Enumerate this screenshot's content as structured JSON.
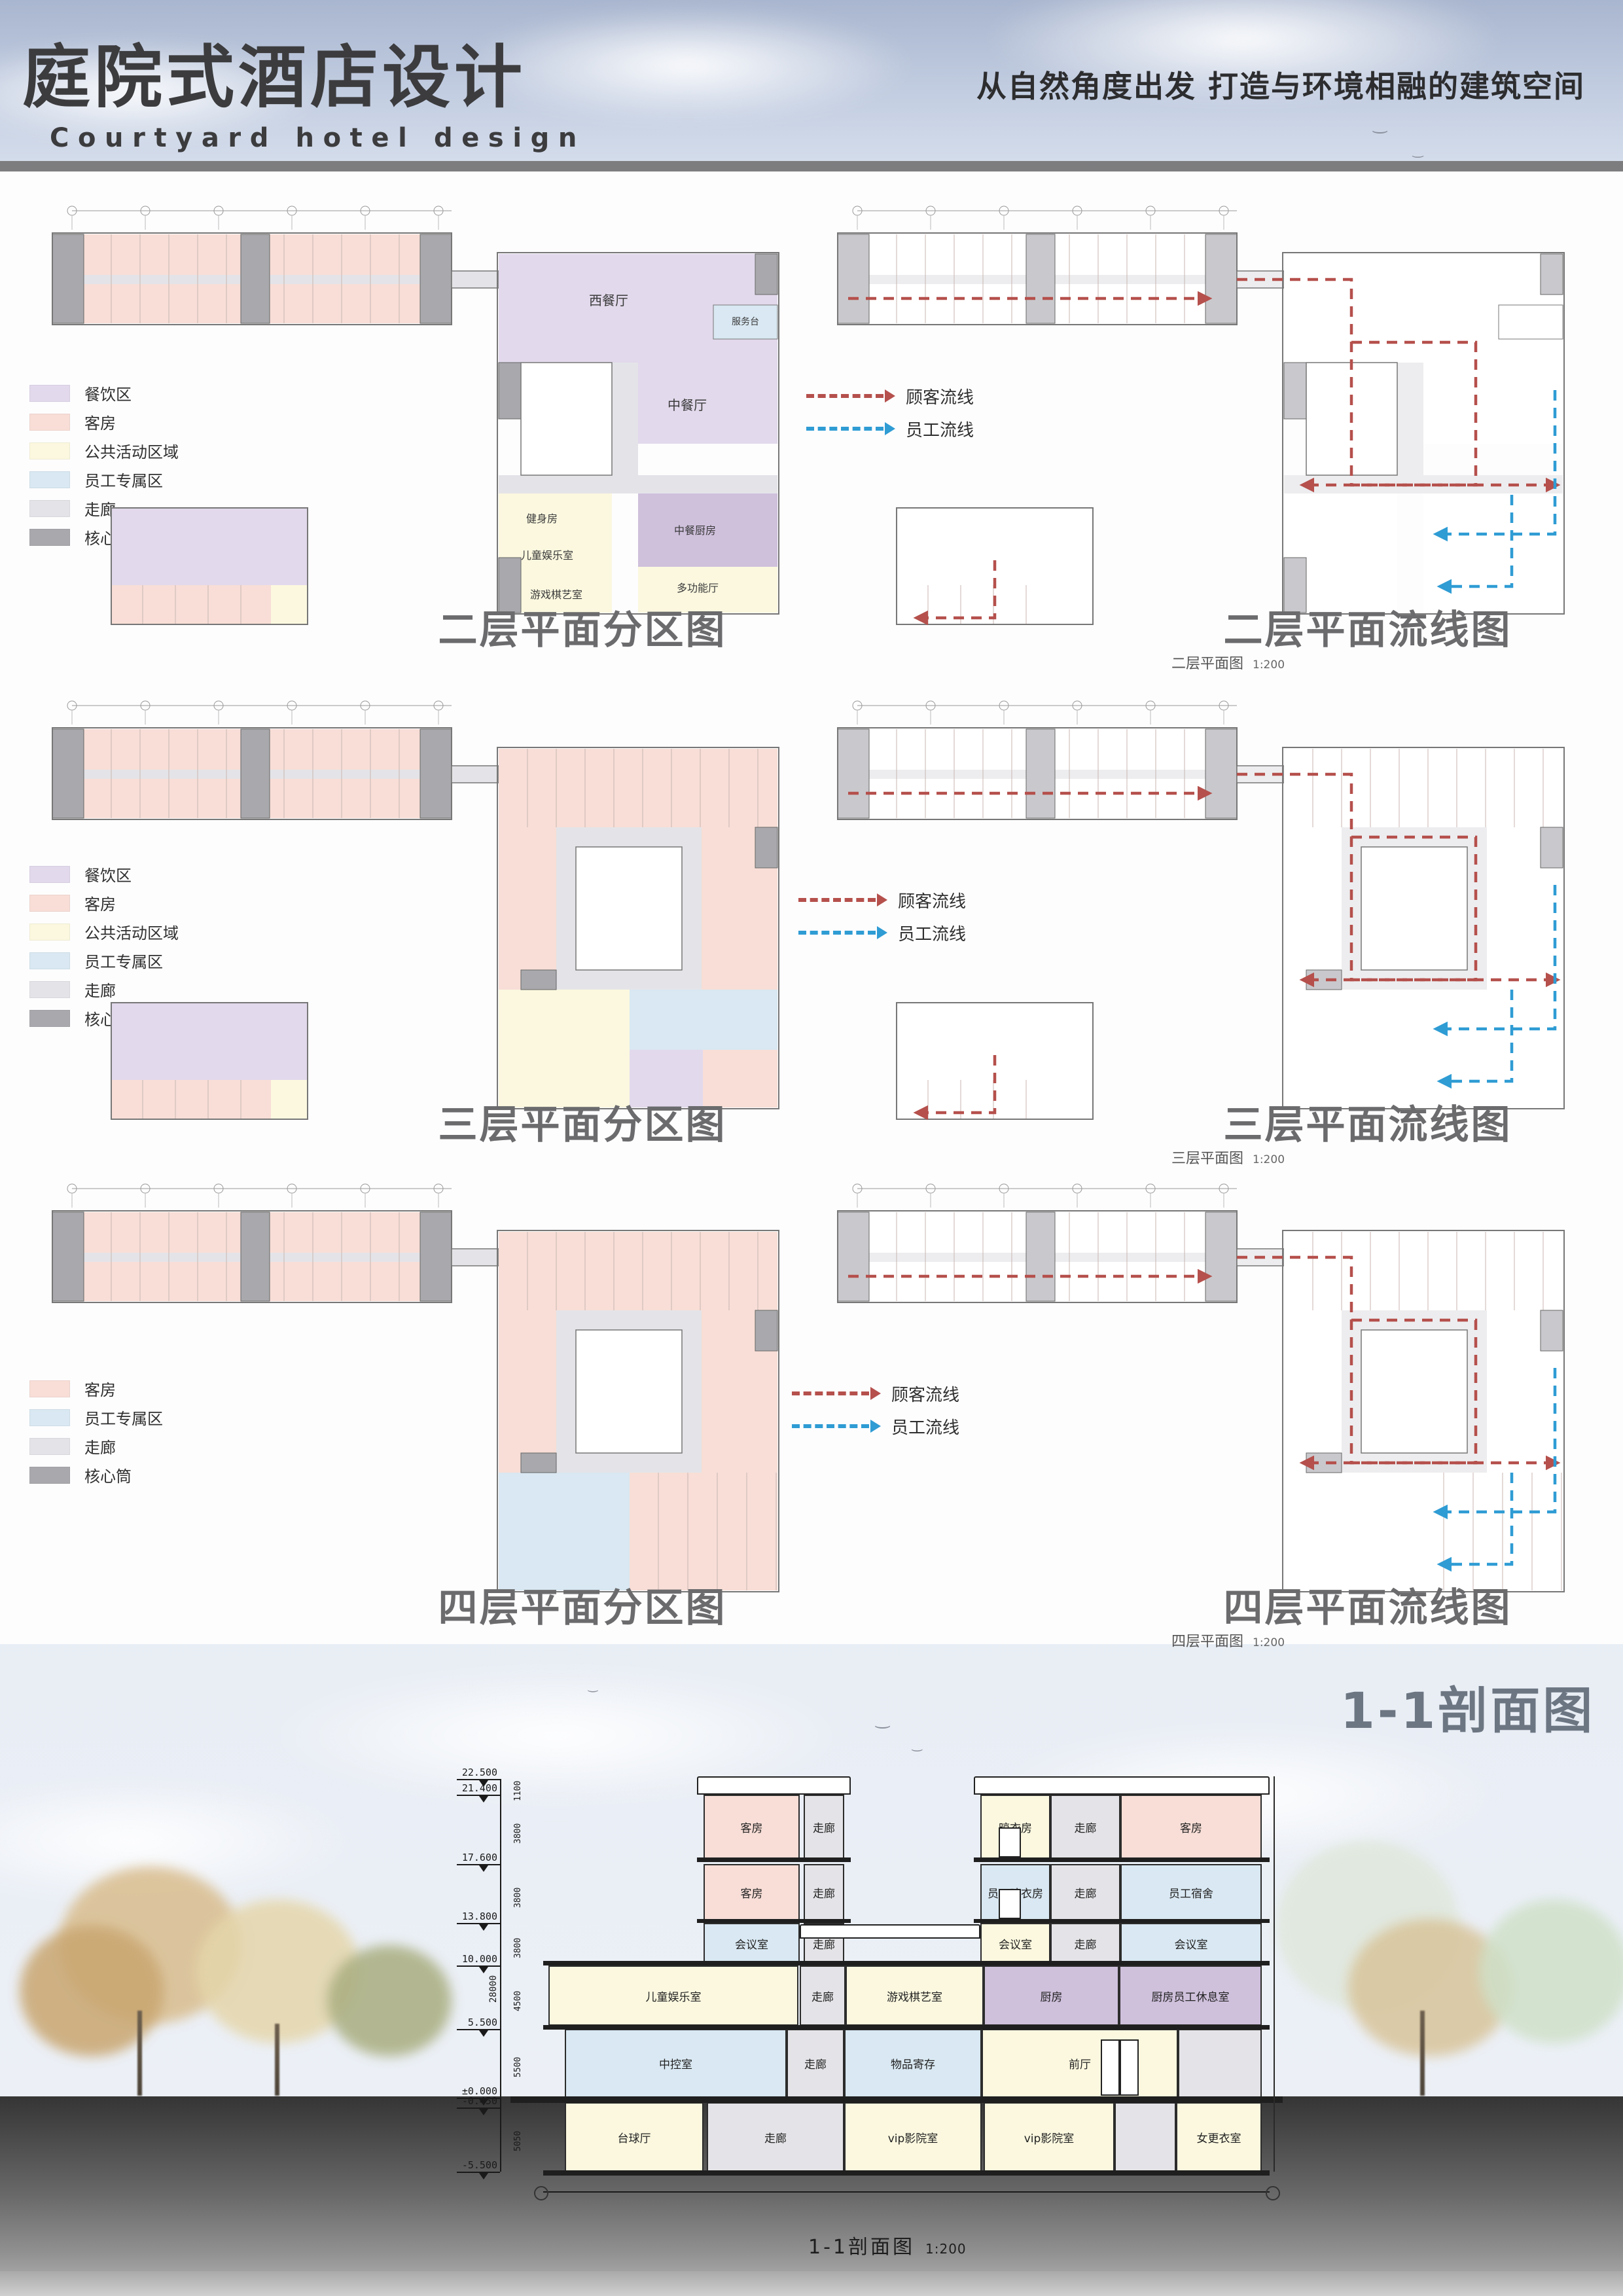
{
  "header": {
    "title_zh": "庭院式酒店设计",
    "title_en": "Courtyard hotel design",
    "slogan": "从自然角度出发 打造与环境相融的建筑空间"
  },
  "palette": {
    "dining": "#e2d9ec",
    "room": "#f8ded7",
    "public": "#fbf8df",
    "staff": "#d9e8f2",
    "corr": "#e4e4e8",
    "core": "#a9a9ad",
    "kitchen": "#cfc0dc",
    "flow_customer": "#b5504c",
    "flow_staff": "#2f9cd4",
    "title_gray": "#6b6b6d"
  },
  "legend_full": [
    {
      "label": "餐饮区",
      "zone": "dining"
    },
    {
      "label": "客房",
      "zone": "room"
    },
    {
      "label": "公共活动区域",
      "zone": "public"
    },
    {
      "label": "员工专属区",
      "zone": "staff"
    },
    {
      "label": "走廊",
      "zone": "corr"
    },
    {
      "label": "核心筒",
      "zone": "core"
    }
  ],
  "legend_small": [
    {
      "label": "客房",
      "zone": "room"
    },
    {
      "label": "员工专属区",
      "zone": "staff"
    },
    {
      "label": "走廊",
      "zone": "corr"
    },
    {
      "label": "核心筒",
      "zone": "core"
    }
  ],
  "flow_legend": [
    {
      "label": "顾客流线",
      "color": "#b5504c"
    },
    {
      "label": "员工流线",
      "color": "#2f9cd4"
    }
  ],
  "floors": [
    {
      "zone_title": "二层平面分区图",
      "flow_title": "二层平面流线图",
      "caption": "二层平面图",
      "caption_scale": "1:200"
    },
    {
      "zone_title": "三层平面分区图",
      "flow_title": "三层平面流线图",
      "caption": "三层平面图",
      "caption_scale": "1:200"
    },
    {
      "zone_title": "四层平面分区图",
      "flow_title": "四层平面流线图",
      "caption": "四层平面图",
      "caption_scale": "1:200"
    }
  ],
  "plan_labels": {
    "floor2": [
      "西餐厅",
      "中餐厅",
      "服务台",
      "健身房",
      "儿童娱乐室",
      "游戏棋艺室",
      "中餐厨房",
      "多功能厅"
    ]
  },
  "section": {
    "title": "1-1剖面图",
    "caption": "1-1剖面图",
    "caption_scale": "1:200",
    "elevations": [
      "22.500",
      "21.400",
      "17.600",
      "13.800",
      "10.000",
      "5.500",
      "±0.000",
      "-0.450",
      "-5.500"
    ],
    "dims": [
      "1100",
      "3800",
      "3800",
      "3800",
      "4500",
      "5500",
      "5050"
    ],
    "total_dim": "28000",
    "floors": [
      {
        "rooms": [
          {
            "label": "客房",
            "zone": "room"
          },
          {
            "label": "走廊",
            "zone": "corr"
          },
          {
            "label": "晾衣房",
            "zone": "public"
          },
          {
            "label": "走廊",
            "zone": "corr"
          },
          {
            "label": "客房",
            "zone": "room"
          }
        ]
      },
      {
        "rooms": [
          {
            "label": "客房",
            "zone": "room"
          },
          {
            "label": "走廊",
            "zone": "corr"
          },
          {
            "label": "员工晾衣房",
            "zone": "staff"
          },
          {
            "label": "走廊",
            "zone": "corr"
          },
          {
            "label": "员工宿舍",
            "zone": "staff"
          }
        ]
      },
      {
        "rooms": [
          {
            "label": "会议室",
            "zone": "staff"
          },
          {
            "label": "走廊",
            "zone": "corr"
          },
          {
            "label": "会议室",
            "zone": "public"
          },
          {
            "label": "走廊",
            "zone": "corr"
          },
          {
            "label": "会议室",
            "zone": "staff"
          }
        ]
      },
      {
        "rooms": [
          {
            "label": "儿童娱乐室",
            "zone": "public"
          },
          {
            "label": "走廊",
            "zone": "corr"
          },
          {
            "label": "游戏棋艺室",
            "zone": "public"
          },
          {
            "label": "厨房",
            "zone": "kitchen"
          },
          {
            "label": "厨房员工休息室",
            "zone": "kitchen"
          }
        ]
      },
      {
        "rooms": [
          {
            "label": "中控室",
            "zone": "staff"
          },
          {
            "label": "走廊",
            "zone": "corr"
          },
          {
            "label": "物品寄存",
            "zone": "staff"
          },
          {
            "label": "前厅",
            "zone": "public"
          },
          {
            "label": "",
            "zone": "corr"
          }
        ]
      },
      {
        "rooms": [
          {
            "label": "台球厅",
            "zone": "public"
          },
          {
            "label": "走廊",
            "zone": "corr"
          },
          {
            "label": "vip影院室",
            "zone": "public"
          },
          {
            "label": "vip影院室",
            "zone": "public"
          },
          {
            "label": "",
            "zone": "corr"
          },
          {
            "label": "女更衣室",
            "zone": "public"
          }
        ]
      }
    ]
  }
}
